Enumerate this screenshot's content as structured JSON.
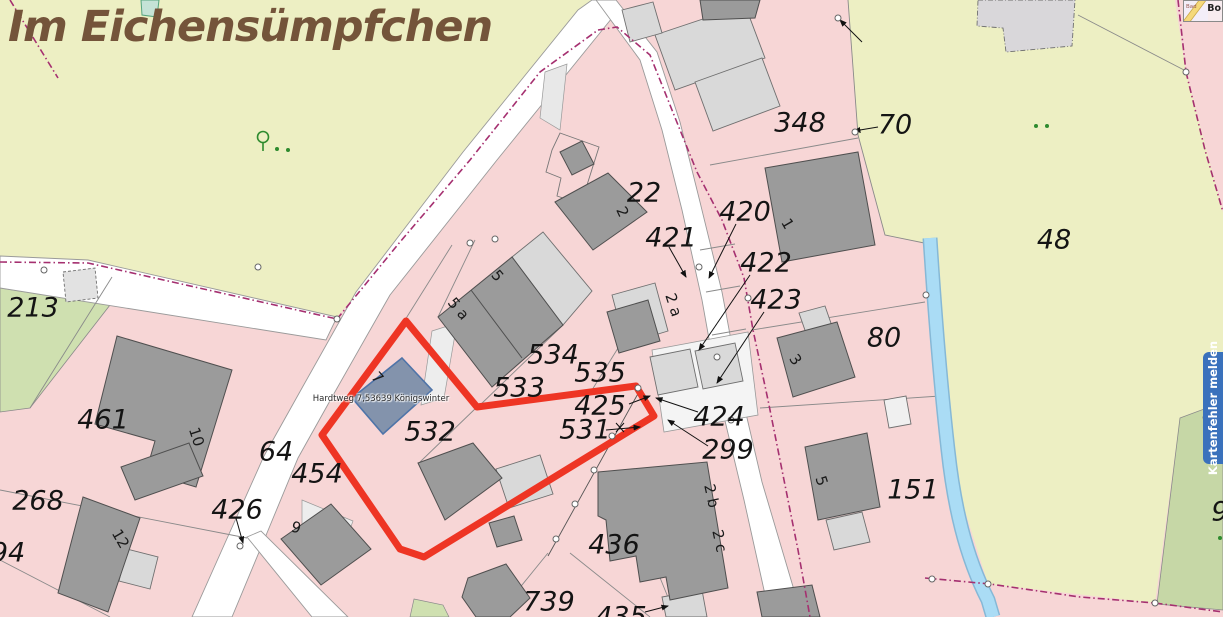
{
  "map": {
    "title": {
      "text": "Im Eichensümpfchen",
      "color": "#74543a"
    },
    "selected_building": {
      "label": "Hardtweg 7,53639 Königswinter"
    },
    "report_tab": {
      "label": "Kartenfehler melden",
      "color": "#3a71bc"
    },
    "minimap": {
      "label_left": "Bad",
      "label_right": "Bo"
    },
    "colors": {
      "parcel_pink": "#f7d6d6",
      "road_white": "#ffffff",
      "field_olive": "#edefc3",
      "meadow_green": "#cfe0b0",
      "meadow_green_dark": "#c6d7a6",
      "building_dark": "#9b9b9b",
      "building_light": "#d9d9d9",
      "selection_red": "#ee3524",
      "selected_building_blue": "#8393ac",
      "stream_blue": "#aadcf5",
      "boundary_magenta": "#a53070",
      "label_black": "#141414",
      "title_brown": "#74543a",
      "report_tab_blue": "#3a71bc",
      "vegetation_green": "#2e8b2e"
    },
    "parcel_labels": [
      {
        "name": "parcel-label-348",
        "text": "348",
        "x": 800,
        "y": 123,
        "size": 27
      },
      {
        "name": "parcel-label-70",
        "text": "70",
        "x": 895,
        "y": 125,
        "size": 27
      },
      {
        "name": "parcel-label-48",
        "text": "48",
        "x": 1054,
        "y": 240,
        "size": 27
      },
      {
        "name": "parcel-label-22",
        "text": "22",
        "x": 644,
        "y": 193,
        "size": 27
      },
      {
        "name": "parcel-label-421",
        "text": "421",
        "x": 671,
        "y": 238,
        "size": 27
      },
      {
        "name": "parcel-label-420",
        "text": "420",
        "x": 745,
        "y": 212,
        "size": 27
      },
      {
        "name": "parcel-label-422",
        "text": "422",
        "x": 766,
        "y": 263,
        "size": 27
      },
      {
        "name": "parcel-label-423",
        "text": "423",
        "x": 776,
        "y": 300,
        "size": 27
      },
      {
        "name": "parcel-label-80",
        "text": "80",
        "x": 884,
        "y": 338,
        "size": 27
      },
      {
        "name": "parcel-label-213",
        "text": "213",
        "x": 33,
        "y": 308,
        "size": 27
      },
      {
        "name": "parcel-label-461",
        "text": "461",
        "x": 103,
        "y": 420,
        "size": 27
      },
      {
        "name": "parcel-label-64",
        "text": "64",
        "x": 276,
        "y": 452,
        "size": 27
      },
      {
        "name": "parcel-label-454",
        "text": "454",
        "x": 317,
        "y": 474,
        "size": 27
      },
      {
        "name": "parcel-label-426",
        "text": "426",
        "x": 237,
        "y": 510,
        "size": 27
      },
      {
        "name": "parcel-label-268",
        "text": "268",
        "x": 38,
        "y": 501,
        "size": 27
      },
      {
        "name": "parcel-label-94",
        "text": "94",
        "x": 8,
        "y": 553,
        "size": 27
      },
      {
        "name": "parcel-label-534",
        "text": "534",
        "x": 553,
        "y": 355,
        "size": 27
      },
      {
        "name": "parcel-label-533",
        "text": "533",
        "x": 519,
        "y": 388,
        "size": 27
      },
      {
        "name": "parcel-label-535",
        "text": "535",
        "x": 600,
        "y": 373,
        "size": 27
      },
      {
        "name": "parcel-label-425",
        "text": "425",
        "x": 600,
        "y": 406,
        "size": 27
      },
      {
        "name": "parcel-label-531",
        "text": "531",
        "x": 585,
        "y": 430,
        "size": 27
      },
      {
        "name": "parcel-label-532",
        "text": "532",
        "x": 430,
        "y": 432,
        "size": 27
      },
      {
        "name": "parcel-label-424",
        "text": "424",
        "x": 719,
        "y": 417,
        "size": 27
      },
      {
        "name": "parcel-label-299",
        "text": "299",
        "x": 728,
        "y": 450,
        "size": 27
      },
      {
        "name": "parcel-label-436",
        "text": "436",
        "x": 614,
        "y": 545,
        "size": 27
      },
      {
        "name": "parcel-label-151",
        "text": "151",
        "x": 913,
        "y": 490,
        "size": 27
      },
      {
        "name": "parcel-label-739",
        "text": "739",
        "x": 549,
        "y": 602,
        "size": 27
      },
      {
        "name": "parcel-label-435",
        "text": "435",
        "x": 621,
        "y": 617,
        "size": 27
      },
      {
        "name": "parcel-label-9-edge",
        "text": "9",
        "x": 1220,
        "y": 512,
        "size": 27
      }
    ],
    "house_numbers": [
      {
        "name": "house-number-2",
        "text": "2",
        "x": 622,
        "y": 212,
        "size": 15,
        "rot": 65
      },
      {
        "name": "house-number-1",
        "text": "1",
        "x": 787,
        "y": 224,
        "size": 15,
        "rot": 60
      },
      {
        "name": "house-number-2a",
        "text": "2 a",
        "x": 673,
        "y": 305,
        "size": 15,
        "rot": 72
      },
      {
        "name": "house-number-3",
        "text": "3",
        "x": 795,
        "y": 360,
        "size": 15,
        "rot": 55
      },
      {
        "name": "house-number-5a",
        "text": "5 a",
        "x": 458,
        "y": 309,
        "size": 15,
        "rot": 50
      },
      {
        "name": "house-number-5",
        "text": "5",
        "x": 497,
        "y": 276,
        "size": 15,
        "rot": 50
      },
      {
        "name": "house-number-7",
        "text": "7",
        "x": 377,
        "y": 378,
        "size": 15,
        "rot": 48
      },
      {
        "name": "house-number-10",
        "text": "10",
        "x": 196,
        "y": 437,
        "size": 15,
        "rot": 72
      },
      {
        "name": "house-number-12",
        "text": "12",
        "x": 120,
        "y": 539,
        "size": 15,
        "rot": 60
      },
      {
        "name": "house-number-9",
        "text": "9",
        "x": 296,
        "y": 528,
        "size": 15,
        "rot": 15
      },
      {
        "name": "house-number-5-151",
        "text": "5",
        "x": 821,
        "y": 481,
        "size": 15,
        "rot": 72
      },
      {
        "name": "house-number-2b",
        "text": "2 b",
        "x": 711,
        "y": 496,
        "size": 15,
        "rot": 78
      },
      {
        "name": "house-number-2c",
        "text": "2 c",
        "x": 719,
        "y": 541,
        "size": 15,
        "rot": 78
      }
    ]
  }
}
